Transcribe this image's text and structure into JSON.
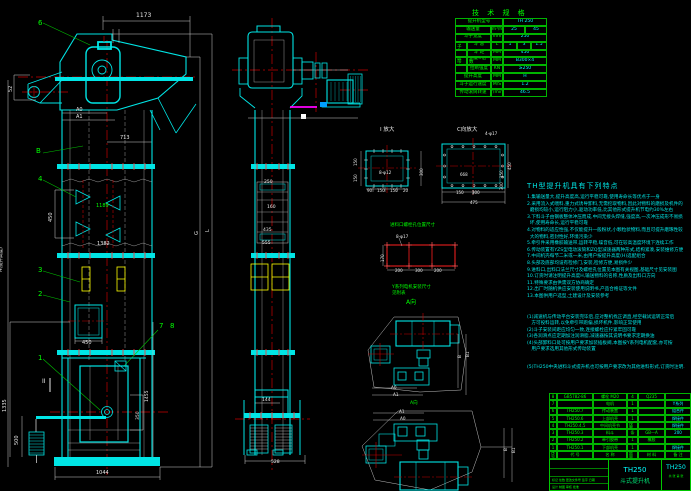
{
  "colors": {
    "cyan": "#00e5e5",
    "green": "#00ff00",
    "red": "#ff2020",
    "white": "#e8e8e8",
    "yellow": "#ffff00",
    "magenta": "#ff00ff",
    "bg": "#000000"
  },
  "drawing": {
    "labels": [
      {
        "t": "1173",
        "x": 136,
        "y": 13,
        "c": "w",
        "s": 6
      },
      {
        "t": "6",
        "x": 38,
        "y": 20,
        "c": "g",
        "s": 7
      },
      {
        "t": "52",
        "x": 9,
        "y": 92,
        "c": "w",
        "r": -90,
        "s": 5
      },
      {
        "t": "A0",
        "x": 76,
        "y": 108,
        "c": "w",
        "s": 5
      },
      {
        "t": "A1",
        "x": 76,
        "y": 115,
        "c": "w",
        "s": 5
      },
      {
        "t": "B",
        "x": 36,
        "y": 148,
        "c": "g",
        "s": 7
      },
      {
        "t": "713",
        "x": 120,
        "y": 136,
        "c": "w",
        "s": 5
      },
      {
        "t": "4",
        "x": 38,
        "y": 176,
        "c": "g",
        "s": 7
      },
      {
        "t": "450",
        "x": 49,
        "y": 222,
        "c": "w",
        "r": -90,
        "s": 5
      },
      {
        "t": "1189",
        "x": 96,
        "y": 204,
        "c": "g",
        "s": 5
      },
      {
        "t": "1382",
        "x": 97,
        "y": 242,
        "c": "w",
        "s": 5
      },
      {
        "t": "3",
        "x": 38,
        "y": 267,
        "c": "g",
        "s": 7
      },
      {
        "t": "2",
        "x": 38,
        "y": 291,
        "c": "g",
        "s": 7
      },
      {
        "t": "450",
        "x": 82,
        "y": 341,
        "c": "w",
        "s": 5
      },
      {
        "t": "7",
        "x": 159,
        "y": 323,
        "c": "g",
        "s": 7
      },
      {
        "t": "8",
        "x": 170,
        "y": 323,
        "c": "g",
        "s": 7
      },
      {
        "t": "1",
        "x": 38,
        "y": 355,
        "c": "g",
        "s": 7
      },
      {
        "t": "II",
        "x": 42,
        "y": 379,
        "c": "w",
        "s": 6
      },
      {
        "t": "H(提升高度)",
        "x": 0,
        "y": 272,
        "c": "w",
        "r": -90,
        "s": 4.5
      },
      {
        "t": "1335",
        "x": 3,
        "y": 412,
        "c": "w",
        "r": -90,
        "s": 5
      },
      {
        "t": "500",
        "x": 15,
        "y": 445,
        "c": "w",
        "r": -90,
        "s": 5
      },
      {
        "t": "350",
        "x": 137,
        "y": 420,
        "c": "w",
        "r": -90,
        "s": 4.5
      },
      {
        "t": "1455",
        "x": 146,
        "y": 402,
        "c": "w",
        "r": -90,
        "s": 4.5
      },
      {
        "t": "1044",
        "x": 96,
        "y": 471,
        "c": "w",
        "s": 5
      },
      {
        "t": "G",
        "x": 195,
        "y": 235,
        "c": "w",
        "r": -90,
        "s": 5
      },
      {
        "t": "L",
        "x": 206,
        "y": 232,
        "c": "w",
        "r": -90,
        "s": 5
      },
      {
        "t": "250",
        "x": 264,
        "y": 181,
        "c": "w",
        "s": 4.5
      },
      {
        "t": "160",
        "x": 267,
        "y": 206,
        "c": "w",
        "s": 4.5
      },
      {
        "t": "435",
        "x": 263,
        "y": 229,
        "c": "w",
        "s": 4.5
      },
      {
        "t": "555",
        "x": 262,
        "y": 242,
        "c": "w",
        "s": 4.5
      },
      {
        "t": "144",
        "x": 262,
        "y": 399,
        "c": "w",
        "s": 4.5
      },
      {
        "t": "528",
        "x": 271,
        "y": 461,
        "c": "w",
        "s": 4.5
      },
      {
        "t": "I 放大",
        "x": 380,
        "y": 128,
        "c": "w",
        "s": 5.5
      },
      {
        "t": "8-φ12",
        "x": 379,
        "y": 171,
        "c": "w",
        "s": 4.2
      },
      {
        "t": "150",
        "x": 354,
        "y": 166,
        "c": "w",
        "r": -90,
        "s": 4
      },
      {
        "t": "150",
        "x": 354,
        "y": 182,
        "c": "w",
        "r": -90,
        "s": 4
      },
      {
        "t": "300",
        "x": 420,
        "y": 176,
        "c": "w",
        "r": -90,
        "s": 4
      },
      {
        "t": "90",
        "x": 367,
        "y": 189,
        "c": "w",
        "s": 4
      },
      {
        "t": "150",
        "x": 377,
        "y": 189,
        "c": "w",
        "s": 4
      },
      {
        "t": "150",
        "x": 390,
        "y": 189,
        "c": "w",
        "s": 4
      },
      {
        "t": "20",
        "x": 403,
        "y": 189,
        "c": "w",
        "s": 4
      },
      {
        "t": "C向放大",
        "x": 457,
        "y": 128,
        "c": "w",
        "s": 5.5
      },
      {
        "t": "4-φ17",
        "x": 485,
        "y": 132,
        "c": "w",
        "s": 4.2
      },
      {
        "t": "668",
        "x": 460,
        "y": 173,
        "c": "w",
        "s": 4
      },
      {
        "t": "450",
        "x": 508,
        "y": 170,
        "c": "w",
        "r": -90,
        "s": 4
      },
      {
        "t": "150",
        "x": 500,
        "y": 178,
        "c": "w",
        "r": -90,
        "s": 4
      },
      {
        "t": "300",
        "x": 500,
        "y": 190,
        "c": "w",
        "r": -90,
        "s": 4
      },
      {
        "t": "150",
        "x": 456,
        "y": 191,
        "c": "w",
        "s": 4
      },
      {
        "t": "300",
        "x": 472,
        "y": 191,
        "c": "w",
        "s": 4
      },
      {
        "t": "475",
        "x": 470,
        "y": 201,
        "c": "w",
        "s": 4
      },
      {
        "t": "进料口螺栓孔位置尺寸",
        "x": 390,
        "y": 224,
        "c": "g",
        "s": 4.5
      },
      {
        "t": "8-φ17",
        "x": 396,
        "y": 235,
        "c": "w",
        "s": 4.2
      },
      {
        "t": "170",
        "x": 381,
        "y": 262,
        "c": "w",
        "r": -90,
        "s": 4
      },
      {
        "t": "200",
        "x": 395,
        "y": 269,
        "c": "w",
        "s": 4
      },
      {
        "t": "300",
        "x": 415,
        "y": 269,
        "c": "w",
        "s": 4
      },
      {
        "t": "200",
        "x": 434,
        "y": 269,
        "c": "w",
        "s": 4
      },
      {
        "t": "Y系列电机安装尺寸",
        "x": 392,
        "y": 286,
        "c": "g",
        "s": 4.5
      },
      {
        "t": "见附表",
        "x": 392,
        "y": 292,
        "c": "g",
        "s": 4.5
      },
      {
        "t": "A向",
        "x": 406,
        "y": 300,
        "c": "g",
        "s": 6
      },
      {
        "t": "A0",
        "x": 391,
        "y": 386,
        "c": "w",
        "s": 4.2
      },
      {
        "t": "A1",
        "x": 393,
        "y": 393,
        "c": "w",
        "s": 4.2
      },
      {
        "t": "B",
        "x": 458,
        "y": 358,
        "c": "w",
        "r": -90,
        "s": 4.2
      },
      {
        "t": "B1",
        "x": 466,
        "y": 357,
        "c": "w",
        "r": -90,
        "s": 4.2
      },
      {
        "t": "A向",
        "x": 410,
        "y": 402,
        "c": "g",
        "s": 4.5
      },
      {
        "t": "A1",
        "x": 399,
        "y": 410,
        "c": "w",
        "s": 4.2
      },
      {
        "t": "A0",
        "x": 400,
        "y": 417,
        "c": "w",
        "s": 4.2
      },
      {
        "t": "B",
        "x": 504,
        "y": 451,
        "c": "w",
        "r": -90,
        "s": 4.2
      },
      {
        "t": "B1",
        "x": 512,
        "y": 453,
        "c": "w",
        "r": -90,
        "s": 4.2
      }
    ]
  },
  "spec_table": {
    "title": "技 术 规 格",
    "rows": [
      [
        {
          "t": "提升机型号",
          "w": 48
        },
        {
          "t": "TH 250",
          "w": 44,
          "c": "c"
        }
      ],
      [
        {
          "t": "输送量",
          "w": 36
        },
        {
          "t": "m³/h",
          "w": 12
        },
        {
          "t": "25",
          "w": 22,
          "c": "c"
        },
        {
          "t": "45",
          "w": 22,
          "c": "c"
        }
      ],
      [
        {
          "t": "斗子宽度",
          "w": 36
        },
        {
          "t": "mm",
          "w": 12
        },
        {
          "t": "250",
          "w": 44,
          "c": "c"
        }
      ],
      [
        {
          "t": "斗子",
          "w": 12
        },
        {
          "t": "斗 容",
          "w": 24
        },
        {
          "t": "L",
          "w": 12
        },
        {
          "t": "1",
          "w": 14,
          "c": "c"
        },
        {
          "t": "3",
          "w": 14,
          "c": "c"
        },
        {
          "t": "1.5",
          "w": 16,
          "c": "c"
        }
      ],
      [
        {
          "t": "",
          "w": 12
        },
        {
          "t": "斗 距",
          "w": 24
        },
        {
          "t": "MM",
          "w": 12
        },
        {
          "t": "450",
          "w": 44,
          "c": "c"
        }
      ],
      [
        {
          "t": "胶带",
          "w": 12
        },
        {
          "t": "宽度×层数",
          "w": 24
        },
        {
          "t": "MM",
          "w": 12
        },
        {
          "t": "B300×4",
          "w": 44,
          "c": "c"
        }
      ],
      [
        {
          "t": "",
          "w": 12
        },
        {
          "t": "拉断强度",
          "w": 24
        },
        {
          "t": "KN",
          "w": 12
        },
        {
          "t": "≥250",
          "w": 44,
          "c": "c"
        }
      ],
      [
        {
          "t": "提升高度",
          "w": 36
        },
        {
          "t": "MM",
          "w": 12
        },
        {
          "t": "H",
          "w": 44,
          "c": "c"
        }
      ],
      [
        {
          "t": "斗子运行速度",
          "w": 36
        },
        {
          "t": "M/S",
          "w": 12
        },
        {
          "t": "1.2",
          "w": 44,
          "c": "c"
        }
      ],
      [
        {
          "t": "传动滚筒转速",
          "w": 36
        },
        {
          "t": "r/min",
          "w": 12
        },
        {
          "t": "46.5",
          "w": 44,
          "c": "c"
        }
      ]
    ]
  },
  "features": {
    "heading": "TH型提升机具有下列特点",
    "lines": [
      "1.集输送量大,提升高度高,运行平稳可靠,使用寿命长等优点于一身",
      "2.采用流入式喂料,重力式诱导卸料,无需挖取物料,因此对物料的磨损及机件的",
      "  磨损均较小,运行阻力小,驱动功率低,比其他形式提升机节电约30%左右",
      "3.下料斗子由钢板整体冲压而成,中间无接头焊缝,强度高,一次冲压成形不易损",
      "  坏,使用寿命长,运行平稳可靠",
      "4.对物料的适应性强,不仅能提升一般粉状,小颗粒状物料,而且可提升磨琢性较",
      "  大的物料,密封性好,环境污染少",
      "5.牵引件采用橡胶输送带,运转平稳,噪音低,可在较高温度环境下连续工作",
      "6.传动装置有YZS型电动滚筒和ZQ型减速器两种形式,结构紧凑,安装维修方便",
      "7.中间机壳每节二米或一米,由用户按提升高度(H)选配组合",
      "8.头部及底部均设有检修门,安装,检修方便,易损件少",
      "9.进料口,出料口法兰尺寸及螺栓孔位置见本图有关视图,基础尺寸见安装图",
      "10.订货时请注明提升高度H,输送物料的名称,性质及出料口方向",
      "11.特殊要求由供需双方协商确定",
      "12.出厂时随机供应安装使用说明书,产品合格证等文件",
      "13.本图供用户选型,土建设计及安装参考"
    ],
    "notes": [
      "(1)减速机与传动平台安装完毕后,应对整机找正调直,经空载试运转正常后",
      "   方可投料运转,以免牵引带跑偏,损坏机件,影响正常使用",
      "(2)斗子安装间距应均匀一致,连接螺栓应拧紧牢固可靠",
      "(3)各润滑点应定期加注润滑脂,减速器按其说明书要求定期换油",
      "(4)头部卸料口处可按用户要求加装插板阀,本图按Y系列电机配套,亦可按",
      "   用户要求选用其他形式传动装置"
    ],
    "footnote": "(5)TH250中央进料斗式提升机也可按用户要求改为其他进料形式,订货时注明."
  },
  "bom": {
    "col_widths": [
      8,
      36,
      34,
      11,
      27,
      26
    ],
    "rows": [
      [
        "8",
        "GB5782-86",
        "螺栓 M20",
        "4",
        "Q235",
        ""
      ],
      [
        "7",
        "",
        "电机",
        "1",
        "",
        "Y系列"
      ],
      [
        "6",
        "TH250.7",
        "传动装置",
        "1",
        "",
        "组合件"
      ],
      [
        "5",
        "TH250.6",
        "上部机壳",
        "1",
        "",
        "焊接件"
      ],
      [
        "4",
        "TH250.4,5",
        "中间机壳节",
        "按需",
        "",
        "焊接件"
      ],
      [
        "3",
        "TH250.3",
        "料斗",
        "条",
        "GB—A",
        "200"
      ],
      [
        "2",
        "TH250.2",
        "牵引胶带",
        "1",
        "橡胶",
        ""
      ],
      [
        "1",
        "TH250.1",
        "下部机壳",
        "1",
        "",
        "焊接件"
      ]
    ],
    "header": [
      "序号",
      "代 号",
      "名 称",
      "数量",
      "材 料",
      "备 注"
    ]
  },
  "title_block": {
    "model": "TH250",
    "name": "斗式提升机",
    "drawing_no": "TH250",
    "sig_row": "标记 处数 更改文件号 签字 日期",
    "sig_row2": "设计  制图  审核  批准",
    "sheet_info": "共 张 第 张"
  }
}
